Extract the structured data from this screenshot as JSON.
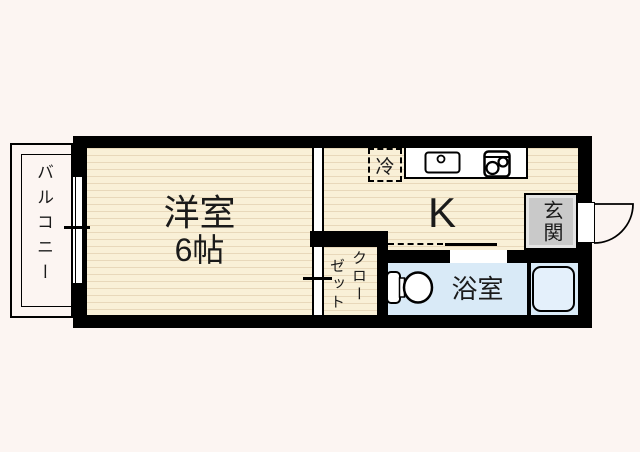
{
  "title": "apartment-floor-plan",
  "colors": {
    "background": "#fcf5f2",
    "wall": "#000000",
    "floor": "#f9f0d7",
    "floor_line": "#e8d8ba",
    "bath_floor": "#d9eaf7",
    "bathtub_fill": "#e4f0fb",
    "entrance_fill": "#c9c9c9",
    "opening": "#ffffff"
  },
  "rooms": {
    "balcony": {
      "label": "バルコニー"
    },
    "western_room": {
      "label": "洋室",
      "size": "6帖"
    },
    "kitchen": {
      "label": "K"
    },
    "closet": {
      "label": "クローゼット",
      "label_col_right": "クロー",
      "label_col_left": "ゼット"
    },
    "entrance": {
      "label": "玄関"
    },
    "bathroom": {
      "label": "浴室"
    },
    "refrigerator": {
      "label": "冷"
    }
  }
}
